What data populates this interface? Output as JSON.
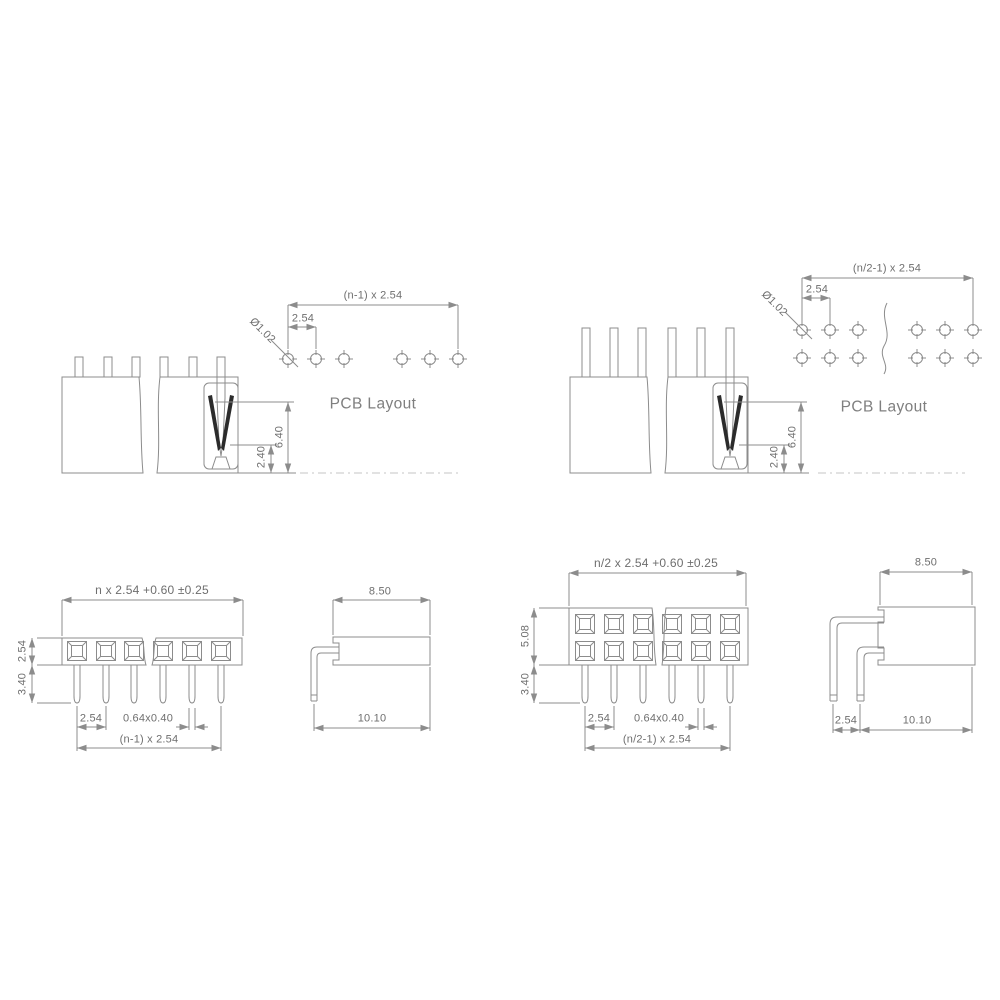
{
  "drawing": {
    "views": {
      "top_left": {
        "pcb_label": "PCB Layout",
        "dims": {
          "span": "(n-1) x 2.54",
          "pitch": "2.54",
          "hole_dia": "Ø1.02",
          "socket_depth": "6.40",
          "entry_depth": "2.40"
        }
      },
      "top_right": {
        "pcb_label": "PCB Layout",
        "dims": {
          "span": "(n/2-1) x 2.54",
          "pitch": "2.54",
          "hole_dia": "Ø1.02",
          "socket_depth": "6.40",
          "entry_depth": "2.40"
        }
      },
      "bottom_left": {
        "dims": {
          "body_width": "n x 2.54 +0.60 ±0.25",
          "body_height": "2.54",
          "pin_length": "3.40",
          "pitch": "2.54",
          "pin_section": "0.64x0.40",
          "span": "(n-1) x 2.54",
          "body_depth": "8.50",
          "overall_depth": "10.10"
        }
      },
      "bottom_right": {
        "dims": {
          "body_width": "n/2 x 2.54 +0.60 ±0.25",
          "body_height": "5.08",
          "pin_length": "3.40",
          "pitch": "2.54",
          "pin_section": "0.64x0.40",
          "span": "(n/2-1) x 2.54",
          "body_depth": "8.50",
          "row_pitch": "2.54",
          "overall_depth": "10.10"
        }
      }
    },
    "colors": {
      "line": "#8c8c8c",
      "text": "#6e6e6e",
      "contact": "#2b2b2b",
      "centerline": "#c6c6c6"
    }
  }
}
